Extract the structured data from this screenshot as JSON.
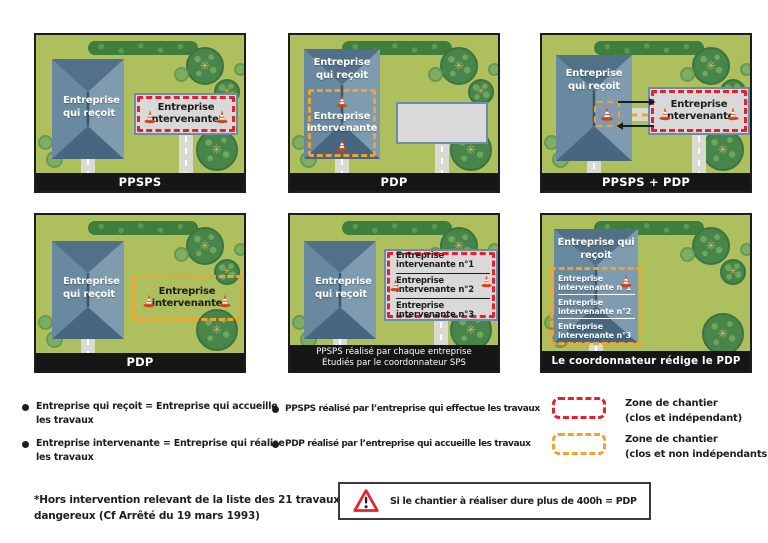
{
  "colors": {
    "field_green": "#aec05e",
    "zone_red": "#e8202e",
    "zone_orange": "#f3a32b",
    "building_blue": "#68899f",
    "caption_bar": "#161616"
  },
  "panels": [
    {
      "caption": "PPSPS",
      "building": "Entreprise qui reçoit",
      "zone": "Entreprise intervenante*"
    },
    {
      "caption": "PDP",
      "building": "Entreprise qui reçoit",
      "zone": "Entreprise intervenante"
    },
    {
      "caption": "PPSPS + PDP",
      "building": "Entreprise qui reçoit",
      "zone": "Entreprise intervenante"
    },
    {
      "caption": "PDP",
      "building": "Entreprise qui reçoit",
      "zone": "Entreprise intervenante"
    },
    {
      "caption_line1": "PPSPS réalisé par chaque entreprise",
      "caption_line2": "Étudiés par le coordonnateur SPS",
      "building": "Entreprise qui reçoit",
      "zones": [
        "Entreprise intervenante n°1",
        "Entreprise intervenante n°2",
        "Entreprise intervenante n°3"
      ]
    },
    {
      "caption": "Le coordonnateur rédige le PDP",
      "building": "Entreprise qui reçoit",
      "zones": [
        "Entreprise intervenante n°1",
        "Entreprise intervenante n°2",
        "Entreprise intervenante n°3"
      ]
    }
  ],
  "legend": {
    "definitions": [
      {
        "line1": "Entreprise qui reçoit = Entreprise qui accueille",
        "line2": "les travaux"
      },
      {
        "line1": "Entreprise intervenante = Entreprise qui réalise",
        "line2": "les travaux"
      },
      {
        "text": "PPSPS réalisé par l’entreprise qui effectue les travaux"
      },
      {
        "text": "PDP réalisé par l’entreprise qui accueille les travaux"
      }
    ],
    "zone_types": [
      {
        "line1": "Zone de chantier",
        "line2": "(clos et indépendant)",
        "color": "#e8202e"
      },
      {
        "line1": "Zone de chantier",
        "line2": "(clos et non indépendants)",
        "color": "#f3a32b"
      }
    ]
  },
  "footnote": {
    "line1": "*Hors intervention relevant de la liste des 21 travaux",
    "line2": "dangereux (Cf Arrêté du 19 mars 1993)"
  },
  "warning": "Si le chantier à réaliser dure plus de 400h = PDP"
}
